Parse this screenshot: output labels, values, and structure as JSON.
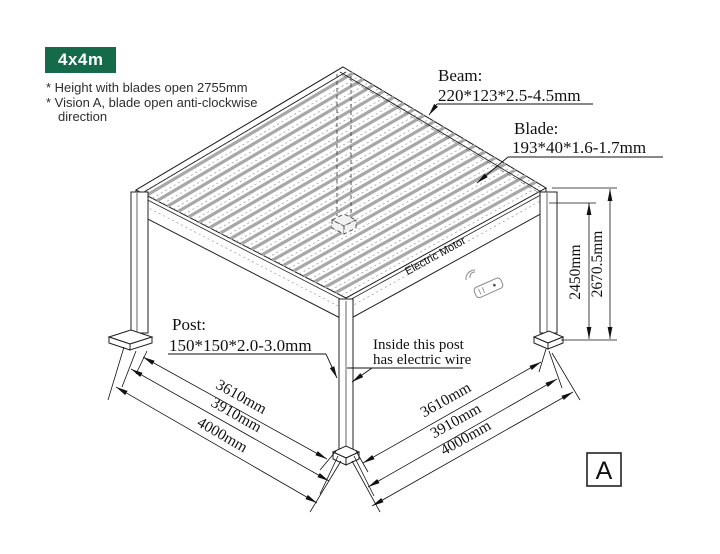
{
  "badge": {
    "label": "4x4m",
    "bg": "#156a4a",
    "fg": "#ffffff"
  },
  "notes": {
    "line1": "* Height with blades open 2755mm",
    "line2": "* Vision A, blade open anti-clockwise",
    "line3": "direction"
  },
  "callouts": {
    "beam": {
      "title": "Beam:",
      "spec": "220*123*2.5-4.5mm"
    },
    "blade": {
      "title": "Blade:",
      "spec": "193*40*1.6-1.7mm"
    },
    "post": {
      "title": "Post:",
      "spec": "150*150*2.0-3.0mm"
    },
    "wire": {
      "line1": "Inside this post",
      "line2": "has electric wire"
    }
  },
  "labels": {
    "motor": "Electric Motor",
    "view": "A"
  },
  "dimensions": {
    "left_bottom": [
      "3610mm",
      "3910mm",
      "4000mm"
    ],
    "right_bottom": [
      "3610mm",
      "3910mm",
      "4000mm"
    ],
    "height_inner": "2450mm",
    "height_outer": "2670.5mm"
  }
}
